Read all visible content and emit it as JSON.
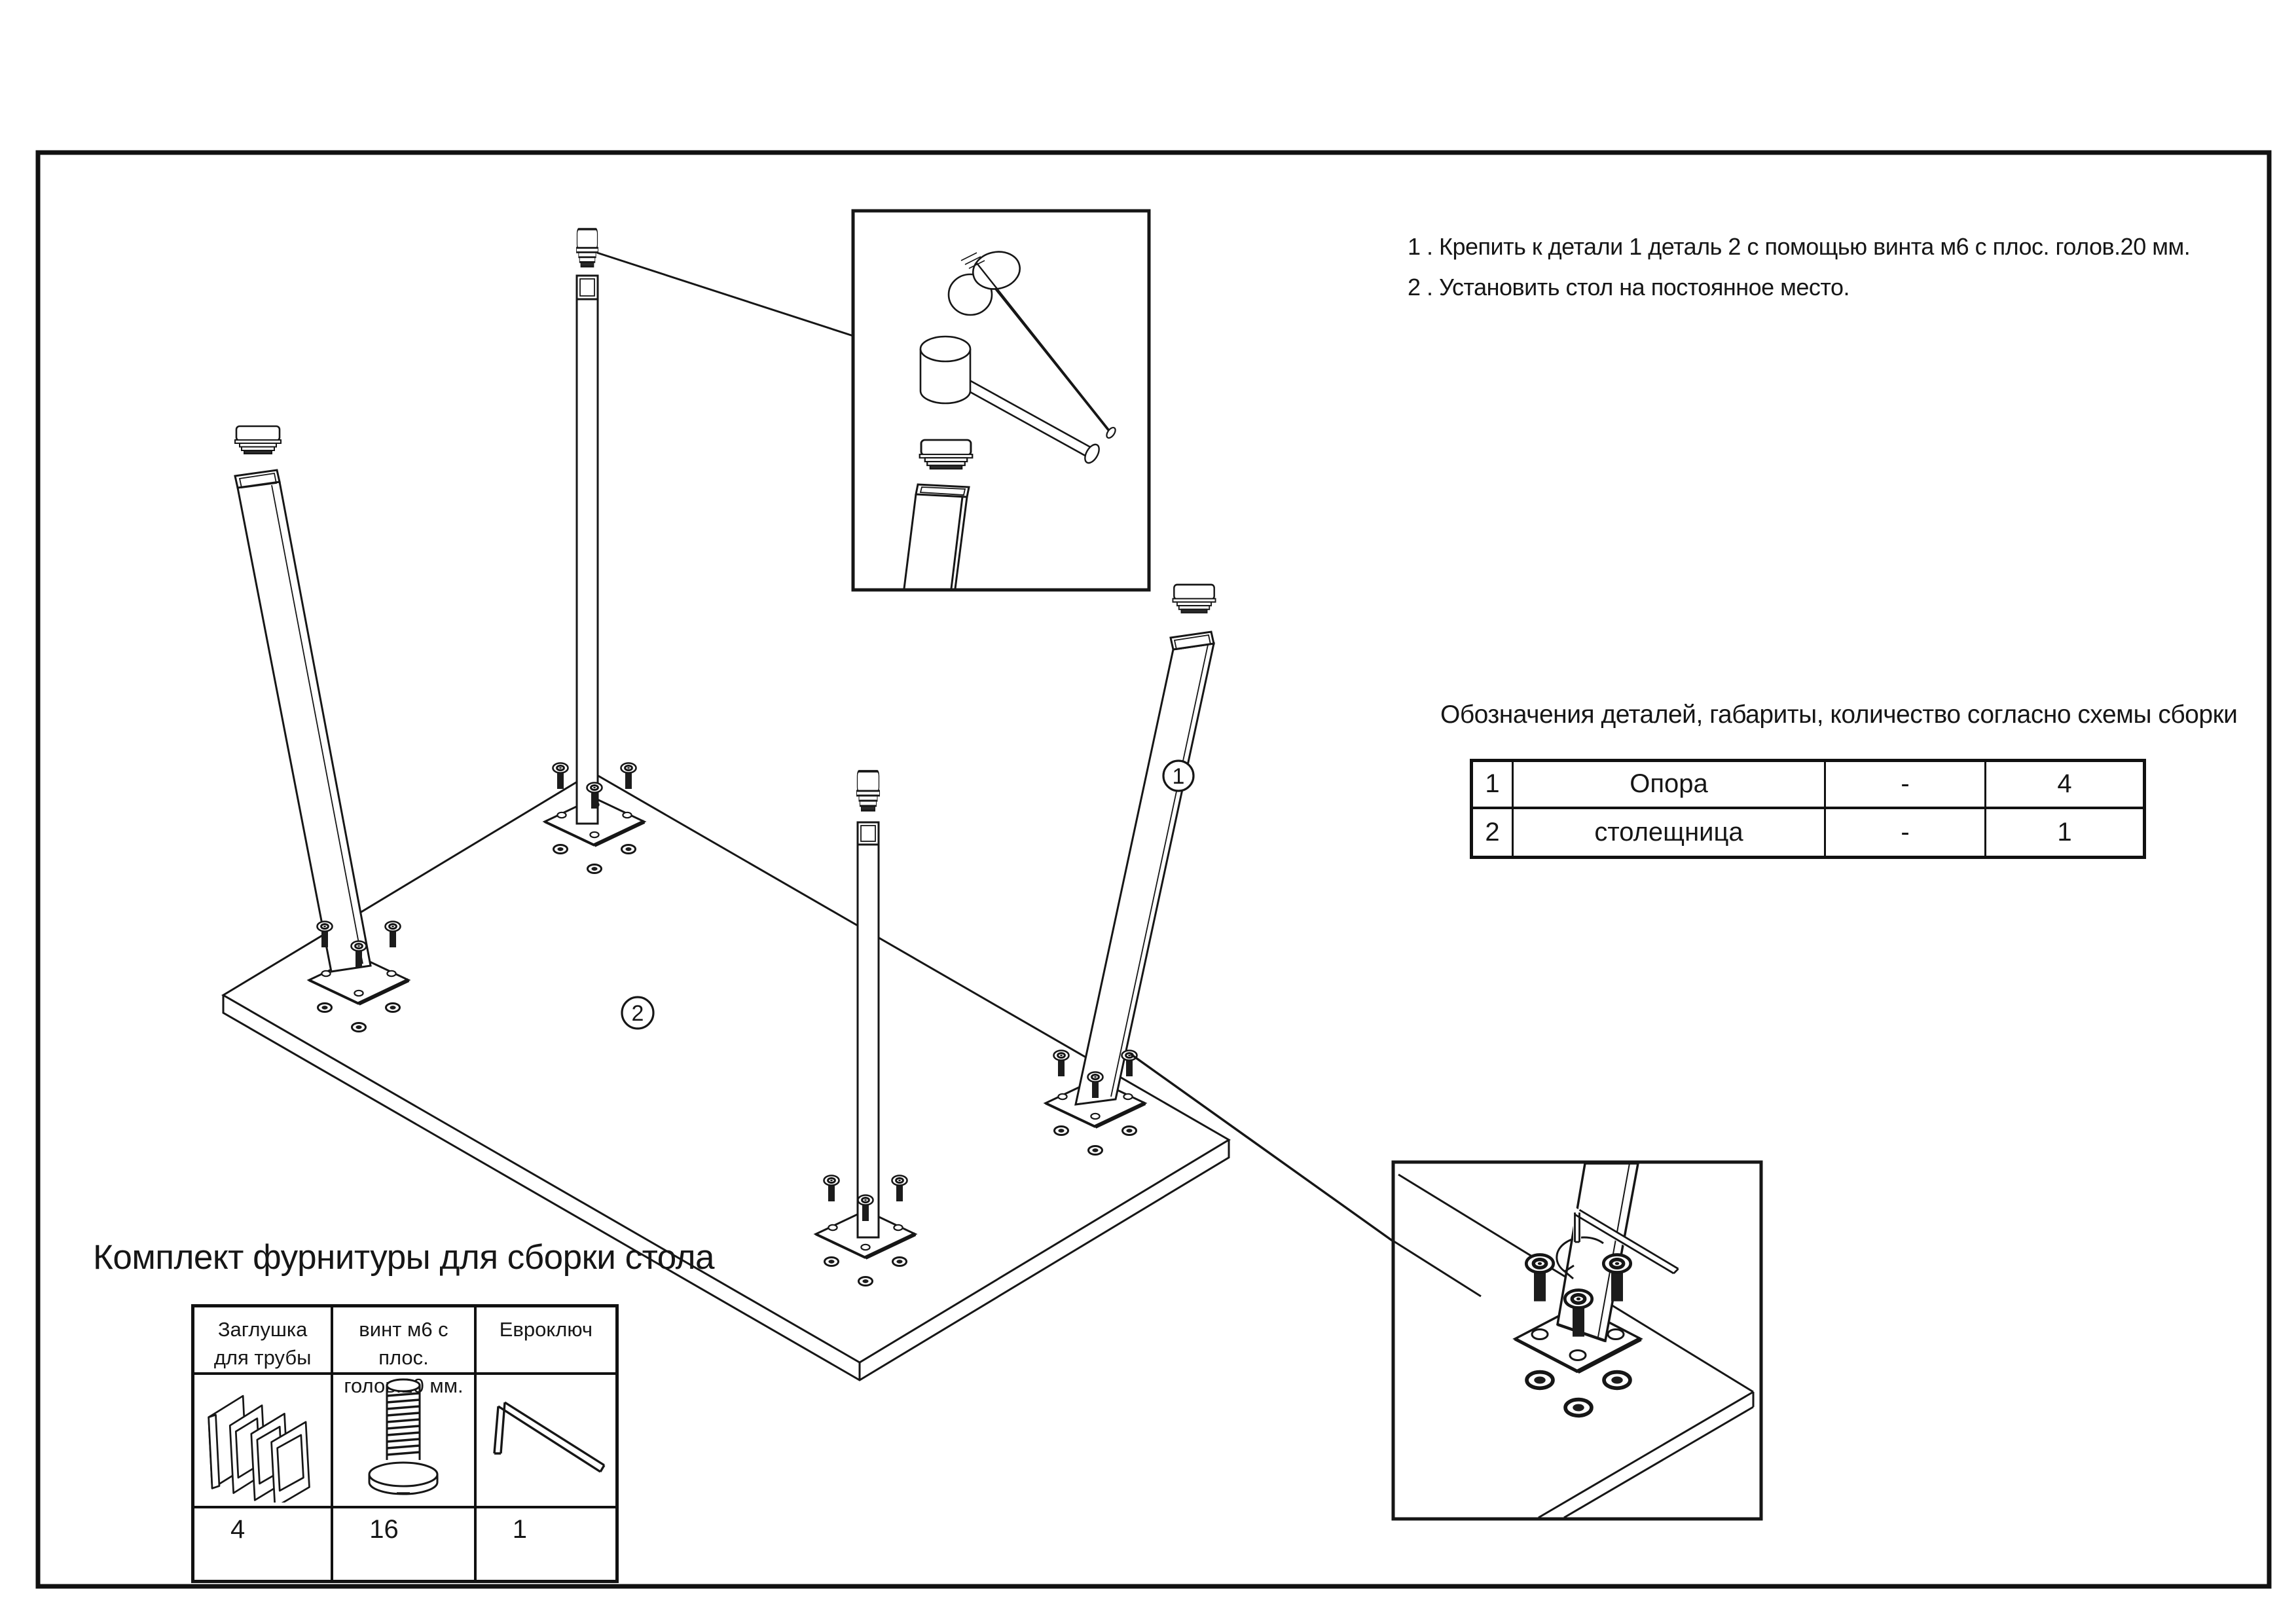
{
  "colors": {
    "line": "#161616",
    "background": "#ffffff",
    "frame": "#111111"
  },
  "instructions": {
    "line1": "1 . Крепить к детали 1 деталь 2 с помощью винта м6 с плос. голов.20 мм.",
    "line2": "2 . Установить стол на постоянное место."
  },
  "designations": {
    "title": "Обозначения деталей, габариты, количество согласно схемы сборки",
    "rows": [
      {
        "num": "1",
        "name": "Опора",
        "dims": "-",
        "qty": "4"
      },
      {
        "num": "2",
        "name": "столещница",
        "dims": "-",
        "qty": "1"
      }
    ]
  },
  "hardware_kit": {
    "title": "Комплект фурнитуры для сборки стола",
    "items": [
      {
        "name_line1": "Заглушка",
        "name_line2": "для трубы",
        "icon": "tube-cap-icon",
        "qty": "4"
      },
      {
        "name_line1": "винт м6 с плос.",
        "name_line2": "голов.20 мм.",
        "icon": "flat-head-screw-icon",
        "qty": "16"
      },
      {
        "name_line1": "Евроключ",
        "name_line2": "",
        "icon": "hex-key-icon",
        "qty": "1"
      }
    ]
  },
  "diagram": {
    "part_labels": [
      {
        "id": "1"
      },
      {
        "id": "2"
      }
    ],
    "callouts": [
      {
        "name": "tube-cap-detail"
      },
      {
        "name": "leg-mounting-detail"
      }
    ]
  }
}
